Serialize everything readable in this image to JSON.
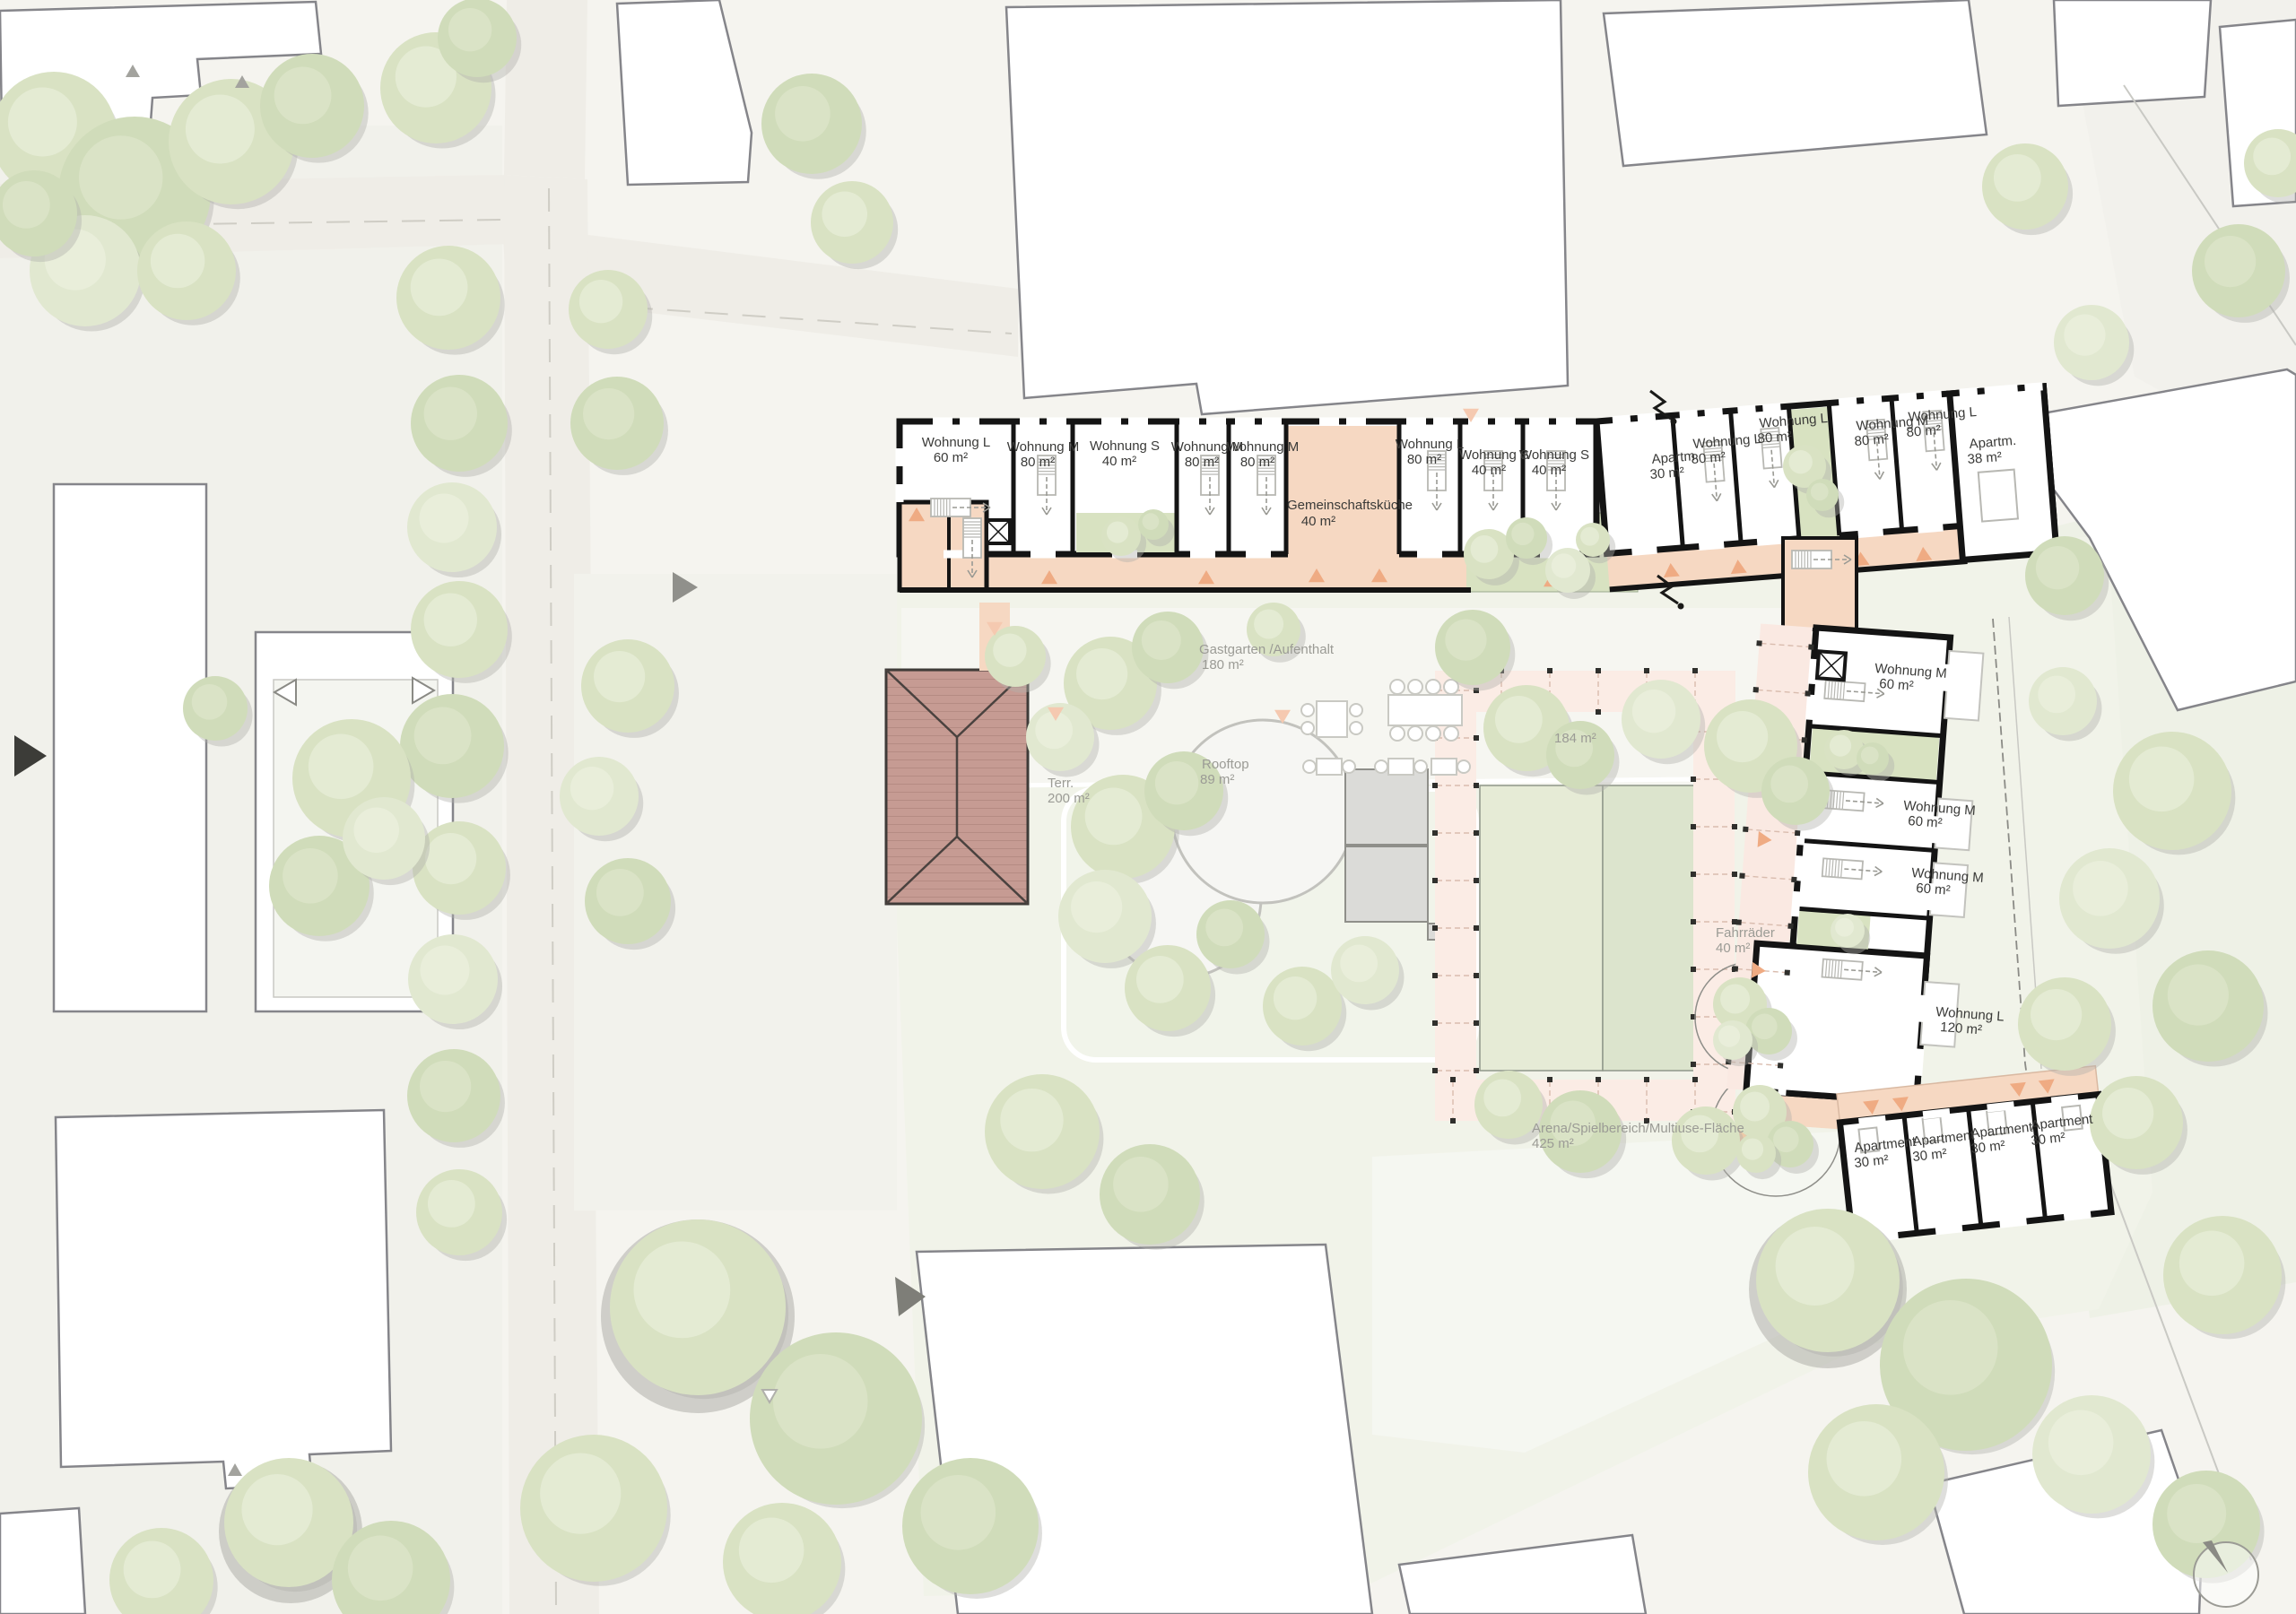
{
  "plan_type": "site-plan-ground-floor",
  "palette": {
    "wall": "#141414",
    "circulation_peach": "#f6d8c2",
    "patio_green": "#d8e2c1",
    "trellis_pink": "#fbece5",
    "roof_red": "#c79c94",
    "field_green": "#dfe6d0",
    "tree_green": "#d9e2c4",
    "context_building": "#ffffff",
    "marker_orange": "#efab83"
  },
  "units": {
    "top_wing": [
      {
        "name": "Wohnung L",
        "area": "60 m²"
      },
      {
        "name": "Wohnung M",
        "area": "80 m²"
      },
      {
        "name": "Wohnung S",
        "area": "40 m²"
      },
      {
        "name": "Wohnung M",
        "area": "80 m²"
      },
      {
        "name": "Wohnung M",
        "area": "80 m²"
      },
      {
        "name": "Gemeinschaftsküche",
        "area": "40 m²"
      },
      {
        "name": "Wohnung L",
        "area": "80 m²"
      },
      {
        "name": "Wohnung S",
        "area": "40 m²"
      },
      {
        "name": "Wohnung S",
        "area": "40 m²"
      }
    ],
    "northeast_wing": [
      {
        "name": "Apartm.",
        "area": "30 m²"
      },
      {
        "name": "Wohnung L",
        "area": "80 m²"
      },
      {
        "name": "Wohnung L",
        "area": "80 m²"
      },
      {
        "name": "Wohnung M",
        "area": "80 m²"
      },
      {
        "name": "Wohnung L",
        "area": "80 m²"
      },
      {
        "name": "Apartm.",
        "area": "38 m²"
      }
    ],
    "east_wing": [
      {
        "name": "Wohnung M",
        "area": "60 m²"
      },
      {
        "name": "Wohnung M",
        "area": "60 m²"
      },
      {
        "name": "Wohnung M",
        "area": "60 m²"
      },
      {
        "name": "Wohnung L",
        "area": "120 m²"
      }
    ],
    "south_row": [
      {
        "name": "Apartment",
        "area": "30 m²"
      },
      {
        "name": "Apartment",
        "area": "30 m²"
      },
      {
        "name": "Apartment",
        "area": "30 m²"
      },
      {
        "name": "Apartment",
        "area": "30 m²"
      }
    ]
  },
  "site_labels": {
    "gastgarten": {
      "name": "Gastgarten /Aufenthalt",
      "area": "180 m²"
    },
    "rooftop": {
      "name": "Rooftop",
      "area": "89 m²"
    },
    "terrace": {
      "name": "Terr.",
      "area": "200 m²"
    },
    "garden_area": {
      "area": "184 m²"
    },
    "bikes": {
      "name": "Fahrräder",
      "area": "40 m²"
    },
    "arena": {
      "name": "Arena/Spielbereich/Multiuse-Fläche",
      "area": "425 m²"
    }
  }
}
